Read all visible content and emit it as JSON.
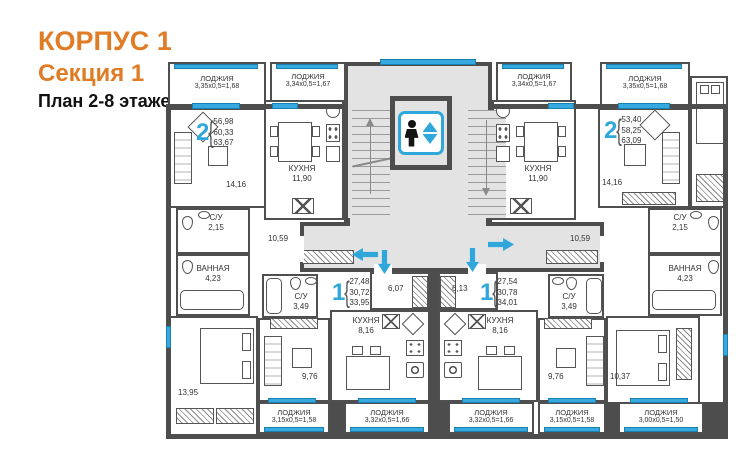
{
  "title": {
    "building": "КОРПУС 1",
    "section": "Секция 1",
    "floors": "План 2-8 этажей"
  },
  "colors": {
    "accent_orange": "#E07C25",
    "accent_blue": "#2FA7DB",
    "glass_blue": "#36A9E1",
    "wall": "#4D4D4D",
    "floor_gray": "#E3E3E3"
  },
  "plan": {
    "brace": "{",
    "apartments": [
      {
        "number": "2",
        "area_lines": [
          "56,98",
          "60,33",
          "63,67"
        ]
      },
      {
        "number": "1",
        "area_lines": [
          "27,48",
          "30,72",
          "33,95"
        ]
      },
      {
        "number": "1",
        "area_lines": [
          "27,54",
          "30,78",
          "34,01"
        ]
      },
      {
        "number": "2",
        "area_lines": [
          "53,40",
          "58,25",
          "63,09"
        ]
      }
    ],
    "rooms": [
      {
        "name": "",
        "area": "14,16"
      },
      {
        "name": "КУХНЯ",
        "area": "11,90"
      },
      {
        "name": "С/У",
        "area": "2,15"
      },
      {
        "name": "ВАННАЯ",
        "area": "4,23"
      },
      {
        "name": "",
        "area": "10,59"
      },
      {
        "name": "",
        "area": "13,95"
      },
      {
        "name": "С/У",
        "area": "3,49"
      },
      {
        "name": "",
        "area": "6,07"
      },
      {
        "name": "КУХНЯ",
        "area": "8,16"
      },
      {
        "name": "",
        "area": "9,76"
      },
      {
        "name": "",
        "area": "6,13"
      },
      {
        "name": "С/У",
        "area": "3,49"
      },
      {
        "name": "КУХНЯ",
        "area": "8,16"
      },
      {
        "name": "",
        "area": "9,76"
      },
      {
        "name": "КУХНЯ",
        "area": "11,90"
      },
      {
        "name": "",
        "area": "14,16"
      },
      {
        "name": "С/У",
        "area": "2,15"
      },
      {
        "name": "ВАННАЯ",
        "area": "4,23"
      },
      {
        "name": "",
        "area": "10,59"
      },
      {
        "name": "",
        "area": "10,37"
      }
    ],
    "lodges": [
      {
        "name": "ЛОДЖИЯ",
        "dims": "3,35х0,5=1,68"
      },
      {
        "name": "ЛОДЖИЯ",
        "dims": "3,34х0,5=1,67"
      },
      {
        "name": "ЛОДЖИЯ",
        "dims": "3,34х0,5=1,67"
      },
      {
        "name": "ЛОДЖИЯ",
        "dims": "3,35х0,5=1,68"
      },
      {
        "name": "ЛОДЖИЯ",
        "dims": "3,15х0,5=1,58"
      },
      {
        "name": "ЛОДЖИЯ",
        "dims": "3,32х0,5=1,66"
      },
      {
        "name": "ЛОДЖИЯ",
        "dims": "3,32х0,5=1,66"
      },
      {
        "name": "ЛОДЖИЯ",
        "dims": "3,15х0,5=1,58"
      },
      {
        "name": "ЛОДЖИЯ",
        "dims": "3,00х0,5=1,50"
      }
    ]
  }
}
